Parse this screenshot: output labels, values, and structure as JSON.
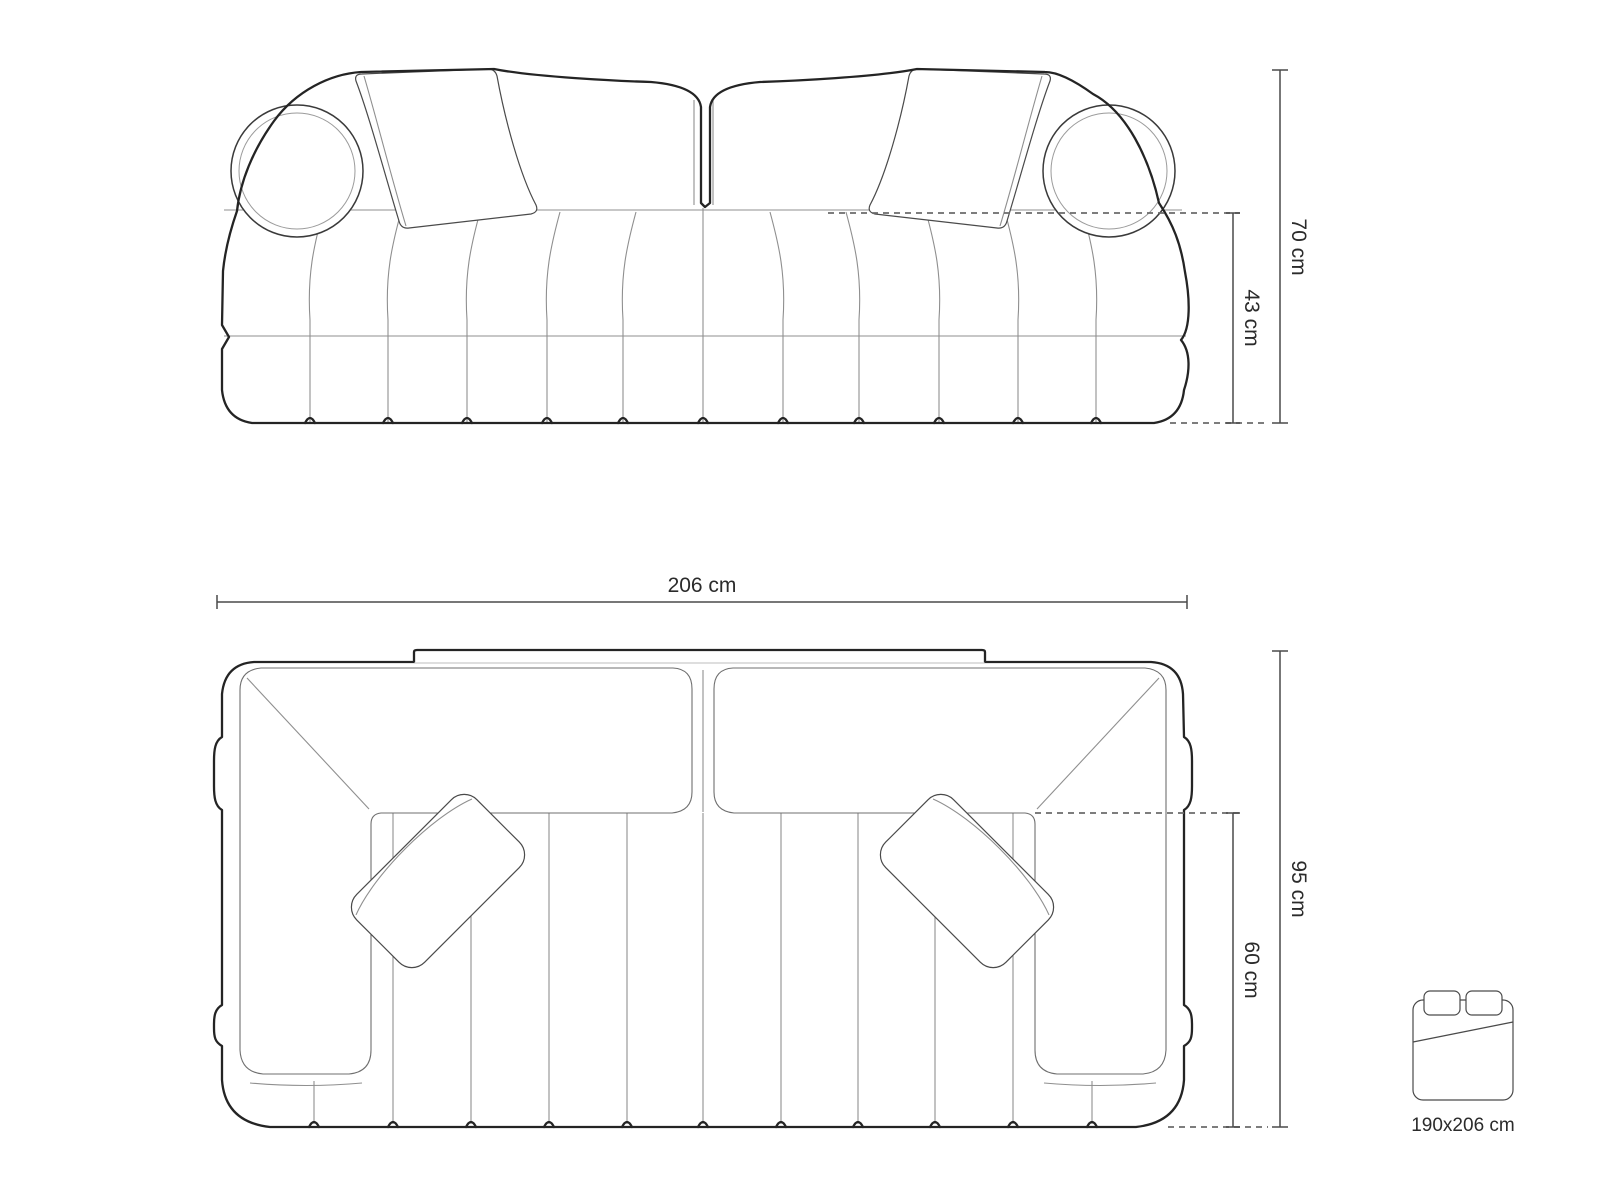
{
  "dimensions": {
    "front_view": {
      "total_height": "70 cm",
      "seat_height": "43 cm"
    },
    "top_view": {
      "width": "206 cm",
      "depth": "95 cm",
      "seat_depth": "60 cm"
    }
  },
  "sleeping_area": {
    "size": "190x206 cm"
  },
  "colors": {
    "outline": "#242424",
    "thin_line": "#8f8f8f",
    "dimension_line": "#4a4a4a",
    "dashed_line": "#6b6b6b",
    "text": "#2b2b2b",
    "background": "#ffffff"
  }
}
